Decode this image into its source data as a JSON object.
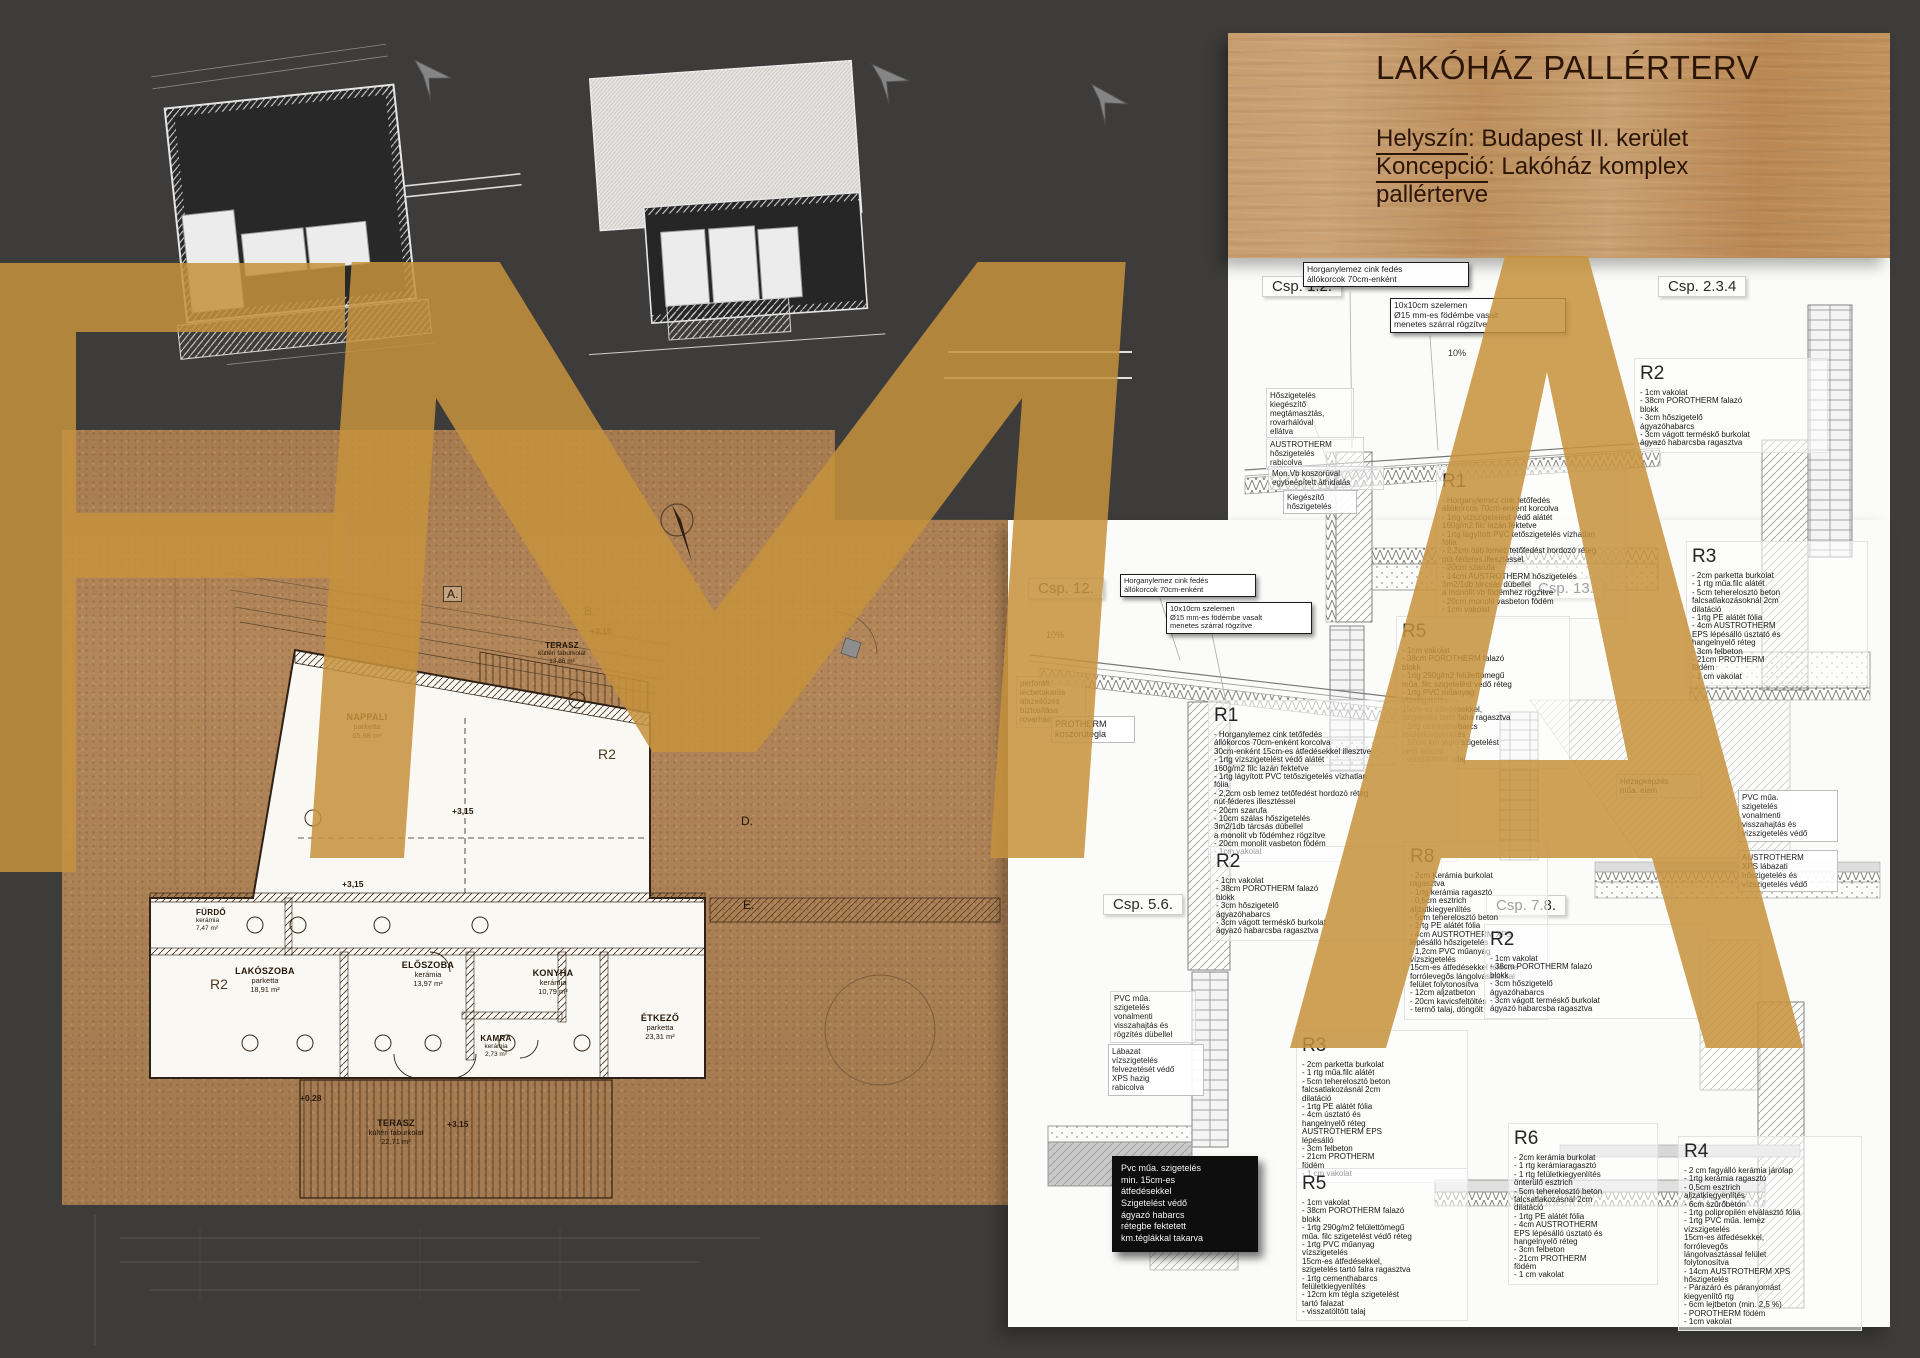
{
  "title_block": {
    "title": "LAKÓHÁZ PALLÉRTERV",
    "helyszin_label": "Helyszín",
    "helyszin_value": ": Budapest II. kerület",
    "koncepcio_label": "Koncepció",
    "koncepcio_value": ": Lakóház  komplex",
    "line3": "pallérterve"
  },
  "watermark": {
    "letters": "FMA",
    "color": "#c6913c"
  },
  "plan": {
    "rooms": [
      {
        "name": "NAPPALI",
        "sub": "parketta\n65,88 m²"
      },
      {
        "name": "TERASZ",
        "sub": "kültéri faburkolat\n13,86 m²"
      },
      {
        "name": "FÜRDŐ",
        "sub": "kerámia\n7,47 m²"
      },
      {
        "name": "LAKÓSZOBA",
        "sub": "parketta\n18,91 m²"
      },
      {
        "name": "ELŐSZOBA",
        "sub": "kerámia\n13,97 m²"
      },
      {
        "name": "KONYHA",
        "sub": "kerámia\n10,79 m²"
      },
      {
        "name": "KAMRA",
        "sub": "kerámia\n2,73 m²"
      },
      {
        "name": "ÉTKEZŐ",
        "sub": "parketta\n23,31 m²"
      },
      {
        "name": "TERASZ",
        "sub": "kültéri faburkolat\n22,71 m²"
      }
    ],
    "r_mark": "R2",
    "levels": {
      "main": "+3,15",
      "terrace": "+0,28"
    },
    "grid_marks": {
      "a": "A.",
      "b": "B.",
      "d": "D.",
      "e": "E."
    }
  },
  "details": {
    "csp_labels": {
      "c12": "Csp. 1.2.",
      "c234": "Csp. 2.3.4",
      "c12b": "Csp. 12.",
      "c13": "Csp. 13.",
      "c56": "Csp. 5.6.",
      "c78": "Csp. 7.8."
    },
    "slope": "10%",
    "callouts": {
      "horganylemez": "Horganylemez cink fedés\nállókorcok 70cm-enként",
      "szelemen": "10x10cm szelemen\nØ15 mm-es födémbe vasalt\nmenetes szárral rögzítve",
      "hoszigeteles": "Hőszigetelés\nkiegészítő\nmegtámasztás,\nrovarhálóval\nellátva",
      "austrotherm": "AUSTROTHERM\nhőszigetelés\nrabicolva",
      "monvb": "Mon.Vb koszorúval\negybeépített áthidalás",
      "kiegeszito": "Kiegészítő\nhőszigetelés",
      "perforalt": "perforált\nlécbetakarás\nátszellőzés\nbiztosítása\nrovarhálóval",
      "protherm": "PROTHERM\nkoszorútégla",
      "hezag": "Hézagképzés\nműa. elem",
      "pvc_vonalmenti": "PVC műa.\nszigetelés\nvonalmenti\nvisszahajtás és\nrögzítés dübellel",
      "labazat": "Lábazat\nvízszigetelés\nfelvezetését védő\nXPS hazig\nrabicolva",
      "pvc_black": "Pvc műa. szigetelés\nmin. 15cm-es\nátfedésekkel\nSzigetelést védő\nágyazó habarcs\nrétegbe fektetett\nkm.téglákkal takarva",
      "pvc_right": "PVC műa.\nszigetelés\nvonalmenti\nvisszahajtás és\nvízszigetelés védő",
      "xps_right": "AUSTROTHERM\nXPS lábazati\nhőszigetelés és\nvízszigetelés védő"
    },
    "r_blocks": {
      "r1a": {
        "id": "R1",
        "lines": "- Horganylemez cink tetőfedés\nállókorcos 70cm-enként korcolva\n- 1rtg vízszigetelést védő alátét\n160g/m2 filc lazán fektetve\n- 1rtg lágyított PVC tetőszigetelés vízhatlan\nfólia\n- 2,2cm osb lemez tetőfedést hordozó réteg\nnút-féderes illesztéssel\n- 20cm szarufa\n- 14cm AUSTROTHERM hőszigetelés\n3m2/1db tárcsás dübellel\na monolit vb födémhez rögzítve\n- 20cm monolit vasbeton födém\n- 1cm vakolat"
      },
      "r1b": {
        "id": "R1",
        "lines": "- Horganylemez cink tetőfedés\nállókorcos 70cm-enként korcolva\n30cm-enként 15cm-es átfedésekkel illesztve\n- 1rtg vízszigetelést védő alátét\n160g/m2 filc lazán fektetve\n- 1rtg lágyított PVC tetőszigetelés vízhatlan\nfólia\n- 2,2cm osb lemez tetőfedést hordozó réteg\nnút-féderes illesztéssel\n- 20cm szarufa\n- 10cm szálas hőszigetelés\n3m2/1db tárcsás dübellel\na monolit vb födémhez rögzítve\n- 20cm monolit vasbeton födém\n- 1cm vakolat"
      },
      "r2": {
        "id": "R2",
        "lines": "- 1cm vakolat\n- 38cm POROTHERM falazó\nblokk\n- 3cm hőszigetelő\nágyazóhabarcs\n- 3cm vágott terméskő burkolat\nágyazó habarcsba ragasztva"
      },
      "r3a": {
        "id": "R3",
        "lines": "- 2cm parketta burkolat\n- 1 rtg műa.filc alátét\n- 5cm teherelosztó beton\nfalcsatlakozásoknál 2cm\ndilatáció\n- 1rtg PE alátét fólia\n- 4cm AUSTROTHERM\nEPS lépésálló úsztató és\nhangelnyelő réteg\n- 3cm felbeton\n- 21cm PROTHERM\nfödém\n- 1 cm vakolat"
      },
      "r3b": {
        "id": "R3",
        "lines": "- 2cm parketta burkolat\n- 1 rtg műa.filc alátét\n- 5cm teherelosztó beton\nfalcsatlakozásnál 2cm\ndilatáció\n- 1rtg PE alátét fólia\n- 4cm úsztató és\nhangelnyelő réteg\nAUSTROTHERM EPS\nlépésálló\n- 3cm felbeton\n- 21cm PROTHERM\nfödém\n- 1 cm vakolat"
      },
      "r5": {
        "id": "R5",
        "lines": "- 1cm vakolat\n- 38cm POROTHERM falazó\nblokk\n- 1rtg 290g/m2 felülettömegű\nműa. filc szigetelést védő réteg\n- 1rtg PVC műanyag\nvízszigetelés\n15cm-es átfedésekkel,\nszigetelés tartó falra ragasztva\n- 1rtg cementhabarcs\nfelületkiegyenlítés\n- 12cm km tégla szigetelést\ntartó falazat\n- visszatöltött talaj"
      },
      "r6": {
        "id": "R6",
        "lines": "- 2cm kerámia burkolat\n- 1 rtg kerámiaragasztó\n- 1 rtg felületkiegyenlítés\nönterülő esztrich\n- 5cm teherelosztó beton\nfalcsatlakozásnál 2cm\ndilatáció\n- 1rtg PE alátét fólia\n- 4cm AUSTROTHERM\nEPS lépésálló úsztató és\nhangelnyelő réteg\n- 3cm felbeton\n- 21cm PROTHERM\nfödém\n- 1 cm vakolat"
      },
      "r8": {
        "id": "R8",
        "lines": "- 2cm Kerámia burkolat\nragasztva\n- 1rtg kerámia ragasztó\n- 0,5cm esztrich\naljzatkiegyenlítés\n- 5cm teherelosztó beton\n- 1rtg PE alátét fólia\n- 4cm AUSTROTHERM XPS\nlépésálló hőszigetelés\n- 1,2cm PVC műanyag\nvízszigetelés\n15cm-es átfedésekkel fektetve\nforrólevegős lángolvasztással\nfelület folytonosítva\n- 12cm aljzatbeton\n- 20cm kavicsfeltöltés\n- termő talaj, döngölt"
      },
      "r4": {
        "id": "R4",
        "lines": "- 2 cm fagyálló kerámia járólap\n- 1rtg kerámia ragasztó\n- 0,5cm esztrich\naljzatkiegyenlítés\n- 6cm szűrőbeton\n- 1rtg polipropilén elválasztó fólia\n- 1rtg PVC műa. lemez\nvízszigetelés\n15cm-es átfedésekkel,\nforrólevegős\nlángolvasztással felület\nfolytonosítva\n- 14cm AUSTROTHERM XPS\nhőszigetelés\n- Párazáró és páranyomást\nkiegyenlítő rtg\n- 6cm lejtbeton (min. 2,5 %)\n- POROTHERM födém\n- 1cm vakolat"
      }
    }
  }
}
